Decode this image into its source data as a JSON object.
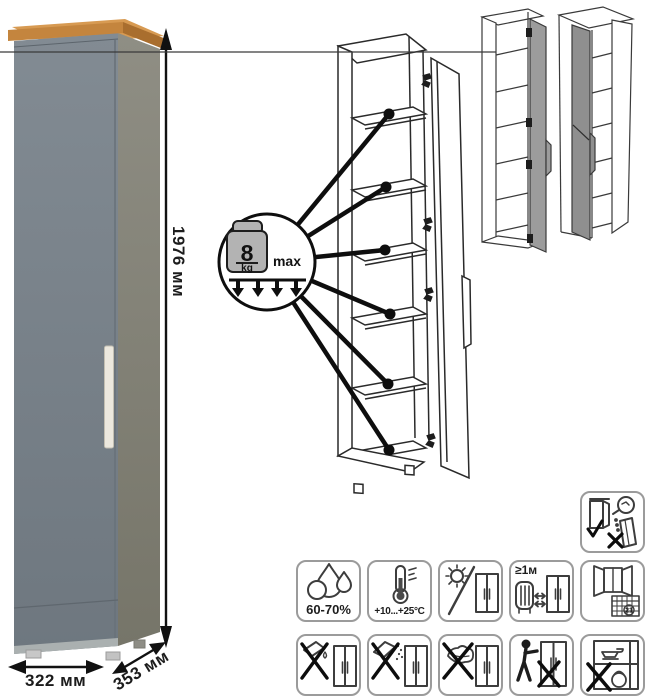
{
  "dimensions": {
    "height": "1976 мм",
    "width": "322 мм",
    "depth": "353 мм"
  },
  "max_load": {
    "value": "8",
    "unit": "kg",
    "qualifier": "max"
  },
  "care": {
    "humidity": {
      "label": "60-70%",
      "icon": "water-drops-icon"
    },
    "temperature": {
      "label": "+10...+25°C",
      "icon": "thermometer-icon"
    },
    "sunlight": {
      "icon": "no-direct-sunlight-icon"
    },
    "heat_distance": {
      "label": "≥1м",
      "icon": "keep-distance-from-heat-icon"
    },
    "ventilation": {
      "calendar_day": "21",
      "icon": "ventilate-room-icon"
    },
    "no_liquids": {
      "icon": "no-liquids-icon"
    },
    "no_powder": {
      "icon": "no-abrasive-powder-icon"
    },
    "no_scrubbing": {
      "icon": "no-scrubbing-icon"
    },
    "no_dragging": {
      "icon": "no-dragging-icon"
    },
    "no_overload": {
      "icon": "no-heavy-objects-icon"
    },
    "anti_tip": {
      "icon": "secure-to-wall-icon"
    }
  },
  "drawings": {
    "photo": "grey-cabinet-wood-top-photo",
    "open_view": "open-cabinet-six-shelves-drawing",
    "variants": [
      "door-hinge-right-variant",
      "door-hinge-left-variant"
    ],
    "shelf_callout_count": 6
  },
  "colors": {
    "wood_top": "#c4853e",
    "wood_side": "#a96e2e",
    "front_panel": "#7b848c",
    "side_panel": "#8a897f",
    "handle": "#ece8de",
    "drawing_door": "#9c9c9c",
    "outline": "#2a2a2a"
  }
}
